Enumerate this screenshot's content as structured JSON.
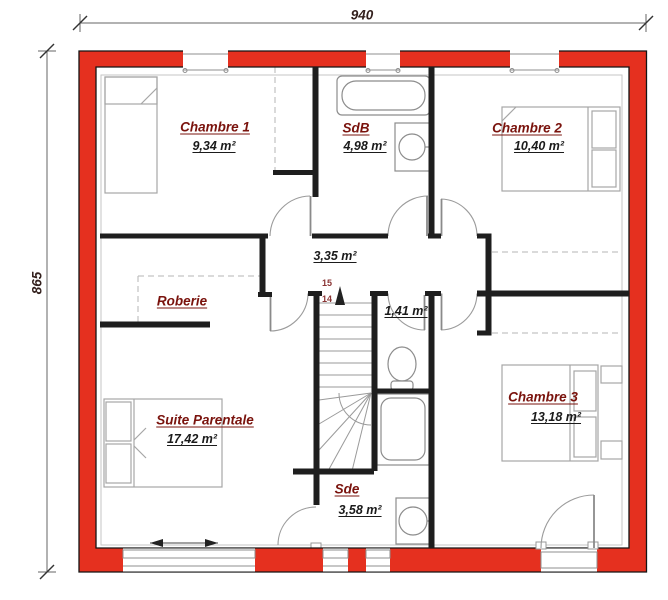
{
  "plan": {
    "type": "floor-plan",
    "dimensions": {
      "width_label": "940",
      "height_label": "865"
    },
    "rooms": [
      {
        "id": "chambre-1",
        "name": "Chambre 1",
        "area": "9,34 m²"
      },
      {
        "id": "sdb",
        "name": "SdB",
        "area": "4,98 m²"
      },
      {
        "id": "chambre-2",
        "name": "Chambre 2",
        "area": "10,40 m²"
      },
      {
        "id": "palier",
        "name": "",
        "area": "3,35 m²"
      },
      {
        "id": "roberie",
        "name": "Roberie",
        "area": ""
      },
      {
        "id": "wc",
        "name": "",
        "area": "1,41 m²"
      },
      {
        "id": "suite-parentale",
        "name": "Suite Parentale",
        "area": "17,42 m²"
      },
      {
        "id": "chambre-3",
        "name": "Chambre 3",
        "area": "13,18 m²"
      },
      {
        "id": "sde",
        "name": "Sde",
        "area": "3,58 m²"
      }
    ],
    "stairs": {
      "step_upper": "15",
      "step_lower": "14"
    },
    "fixtures": [
      "single-bed",
      "bathtub",
      "washbasin",
      "double-bed",
      "toilet",
      "shower",
      "double-bed",
      "double-bed",
      "washbasin"
    ],
    "colors": {
      "wall_red": "#e5301f",
      "wall_black": "#1e1e1e",
      "room_name": "#7a130d",
      "area_text": "#1b1b1b",
      "furniture": "#a6a6a6",
      "fixture": "#8c8c8c",
      "dimension": "#33201d",
      "stair_number": "#8a3434"
    }
  }
}
